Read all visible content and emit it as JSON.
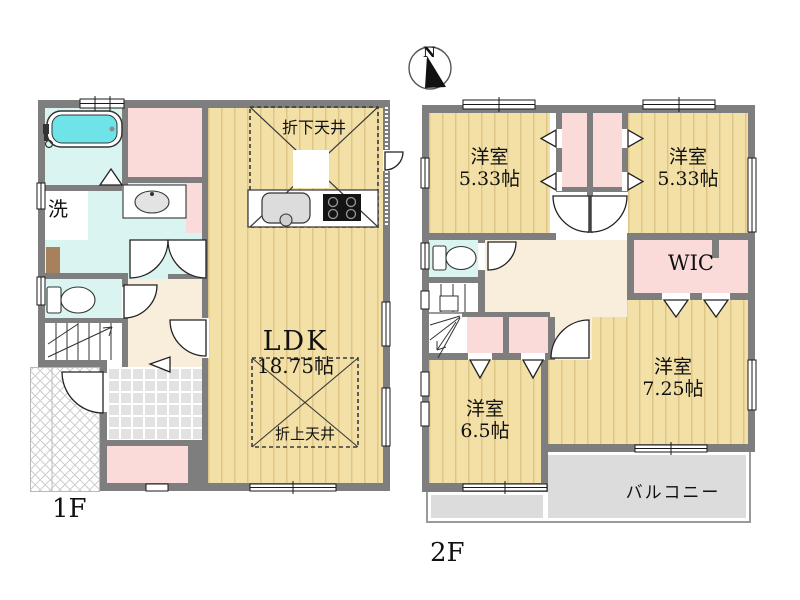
{
  "compass": {
    "north": "N"
  },
  "floor1": {
    "label": "1F",
    "ldk": {
      "name": "LDK",
      "size": "18.75帖"
    },
    "kitchen_ceiling": "折下天井",
    "living_ceiling": "折上天井",
    "washroom": "洗"
  },
  "floor2": {
    "label": "2F",
    "room_nw": {
      "name": "洋室",
      "size": "5.33帖"
    },
    "room_ne": {
      "name": "洋室",
      "size": "5.33帖"
    },
    "wic": "WIC",
    "room_sw": {
      "name": "洋室",
      "size": "6.5帖"
    },
    "room_se": {
      "name": "洋室",
      "size": "7.25帖"
    },
    "balcony": "バルコニー"
  },
  "colors": {
    "wall": "#7e7e7e",
    "wood_floor": "#f3e0a7",
    "closet_pink": "#fbdada",
    "wet_area_cyan": "#d9f4f1",
    "hall_cream": "#f8eedb",
    "entrance_tile": "#e2e2e2",
    "balcony_gray": "#dcdcdc",
    "bathtub_cyan": "#6fe4e8"
  }
}
